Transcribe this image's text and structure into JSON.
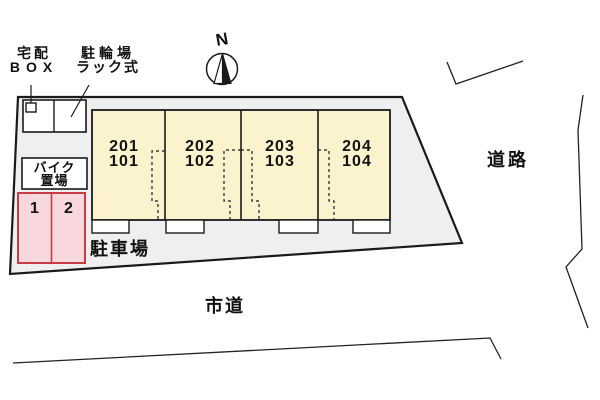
{
  "compass": {
    "label": "N"
  },
  "labels": {
    "delivery_box": {
      "line1": "宅配",
      "line2": "BOX"
    },
    "bicycle_rack": {
      "line1": "駐輪場",
      "line2": "ラック式"
    },
    "bike_storage": {
      "line1": "バイク",
      "line2": "置場"
    },
    "parking_lot": "駐車場",
    "road": "道路",
    "city_road": "市道"
  },
  "units": [
    {
      "upper": "201",
      "lower": "101"
    },
    {
      "upper": "202",
      "lower": "102"
    },
    {
      "upper": "203",
      "lower": "103"
    },
    {
      "upper": "204",
      "lower": "104"
    }
  ],
  "parking_spots": [
    "1",
    "2"
  ],
  "colors": {
    "site_fill": "#EFEFEF",
    "building_fill": "#FAF3CD",
    "spot_fill": "#F9D8DD",
    "spot_border": "#C83C46",
    "outline": "#1A1A1A"
  }
}
